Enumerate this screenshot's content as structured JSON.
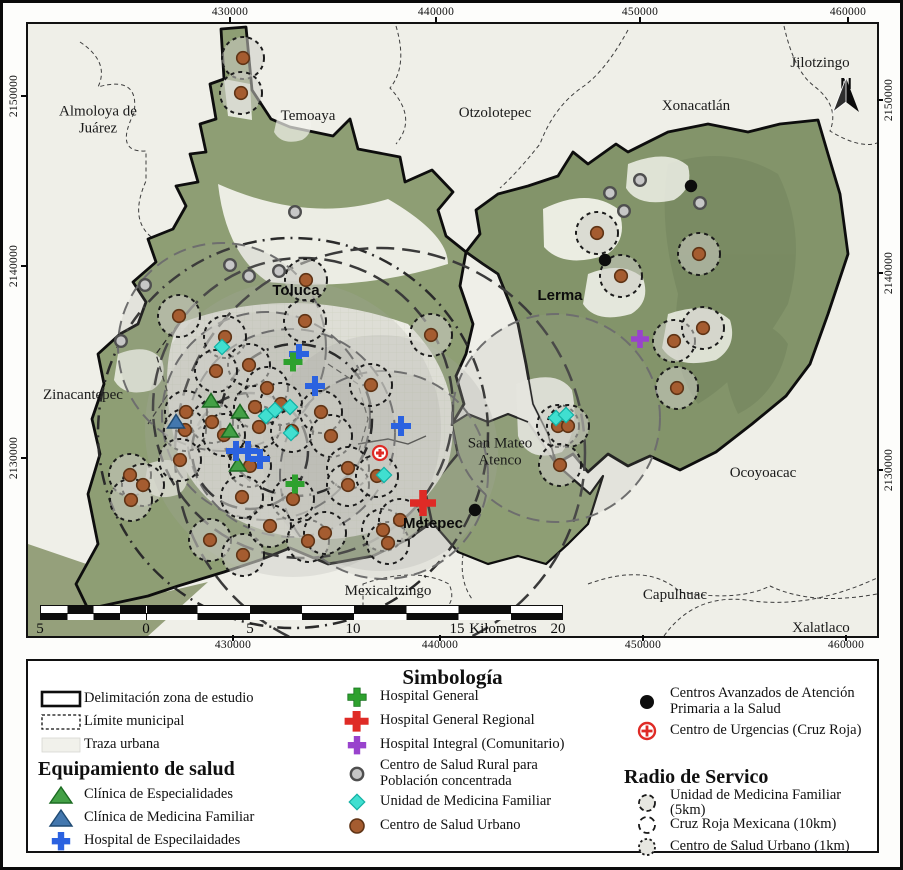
{
  "colors": {
    "black": "#0d0d0d",
    "brown": "#A55C30",
    "brown_dark": "#5F3416",
    "gray": "#C7C7C7",
    "gray_dark": "#4F4F4F",
    "red": "#DF2B26",
    "green": "#2EA12E",
    "purple": "#9943CD",
    "blue": "#2B62E0",
    "green_tri": "#43A046",
    "green_tri_dark": "#1C6B22",
    "blue_tri": "#4377AE",
    "blue_tri_dark": "#1F4A73",
    "cyan": "#40DFD0",
    "cyan_dark": "#14B0A4",
    "zone_fill": "#8E9E74",
    "terrain_fill": "#83946A",
    "urban_fill": "#F2F2EC"
  },
  "map": {
    "north_label": "N",
    "axis_top": [
      {
        "label": "430000",
        "pos": 227
      },
      {
        "label": "440000",
        "pos": 433
      },
      {
        "label": "450000",
        "pos": 637
      },
      {
        "label": "460000",
        "pos": 845
      }
    ],
    "axis_bottom": [
      {
        "label": "430000",
        "pos": 230
      },
      {
        "label": "440000",
        "pos": 437
      },
      {
        "label": "450000",
        "pos": 640
      },
      {
        "label": "460000",
        "pos": 843
      }
    ],
    "axis_left": [
      {
        "label": "2150000",
        "pos": 93
      },
      {
        "label": "2140000",
        "pos": 263
      },
      {
        "label": "2130000",
        "pos": 455
      }
    ],
    "axis_right": [
      {
        "label": "2150000",
        "pos": 97
      },
      {
        "label": "2140000",
        "pos": 270
      },
      {
        "label": "2130000",
        "pos": 467
      }
    ],
    "place_labels": [
      {
        "text": "Almoloya de\nJuárez",
        "x": 70,
        "y": 96,
        "b": 0
      },
      {
        "text": "Temoaya",
        "x": 280,
        "y": 92,
        "b": 0
      },
      {
        "text": "Otzolotepec",
        "x": 467,
        "y": 89,
        "b": 0
      },
      {
        "text": "Xonacatlán",
        "x": 668,
        "y": 82,
        "b": 0
      },
      {
        "text": "Jilotzingo",
        "x": 792,
        "y": 39,
        "b": 0
      },
      {
        "text": "Toluca",
        "x": 268,
        "y": 267,
        "b": 1
      },
      {
        "text": "Lerma",
        "x": 532,
        "y": 272,
        "b": 1
      },
      {
        "text": "Zinacantepec",
        "x": 55,
        "y": 371,
        "b": 0
      },
      {
        "text": "San Mateo\nAtenco",
        "x": 472,
        "y": 428,
        "b": 0
      },
      {
        "text": "Ocoyoacac",
        "x": 735,
        "y": 449,
        "b": 0
      },
      {
        "text": "Metepec",
        "x": 405,
        "y": 500,
        "b": 1
      },
      {
        "text": "Mexicaltzingo",
        "x": 360,
        "y": 567,
        "b": 0
      },
      {
        "text": "Capulhuac",
        "x": 647,
        "y": 571,
        "b": 0
      },
      {
        "text": "Xalatlaco",
        "x": 793,
        "y": 604,
        "b": 0
      }
    ],
    "scalebar_marks": [
      {
        "t": "5",
        "x": 0
      },
      {
        "t": "0",
        "x": 106
      },
      {
        "t": "5",
        "x": 210
      },
      {
        "t": "10",
        "x": 313
      },
      {
        "t": "15",
        "x": 417
      },
      {
        "t": "Kilometros",
        "x": 463
      },
      {
        "t": "20",
        "x": 518
      }
    ],
    "service_circles": [
      [
        265,
        405,
        148,
        "fl"
      ],
      [
        352,
        429,
        118,
        "fl"
      ],
      [
        265,
        409,
        195,
        "dd"
      ],
      [
        352,
        429,
        205,
        "ld"
      ],
      [
        275,
        384,
        150,
        "ld"
      ],
      [
        194,
        323,
        104,
        "d5"
      ],
      [
        238,
        392,
        104,
        "d5"
      ],
      [
        263,
        409,
        104,
        "d5"
      ],
      [
        356,
        451,
        104,
        "d5"
      ],
      [
        528,
        394,
        104,
        "d5"
      ],
      [
        222,
        427,
        58,
        "ld"
      ],
      [
        268,
        396,
        76,
        "dd"
      ]
    ],
    "markers": {
      "csu": [
        [
          215,
          34
        ],
        [
          213,
          69
        ],
        [
          278,
          256
        ],
        [
          151,
          292
        ],
        [
          277,
          297
        ],
        [
          403,
          311
        ],
        [
          197,
          313
        ],
        [
          221,
          341
        ],
        [
          188,
          347
        ],
        [
          239,
          364
        ],
        [
          343,
          361
        ],
        [
          158,
          388
        ],
        [
          184,
          398
        ],
        [
          157,
          406
        ],
        [
          227,
          383
        ],
        [
          231,
          403
        ],
        [
          253,
          380
        ],
        [
          196,
          411
        ],
        [
          264,
          407
        ],
        [
          293,
          388
        ],
        [
          303,
          412
        ],
        [
          320,
          444
        ],
        [
          265,
          475
        ],
        [
          320,
          461
        ],
        [
          349,
          452
        ],
        [
          222,
          442
        ],
        [
          102,
          451
        ],
        [
          115,
          461
        ],
        [
          103,
          476
        ],
        [
          152,
          436
        ],
        [
          182,
          516
        ],
        [
          215,
          531
        ],
        [
          242,
          502
        ],
        [
          280,
          517
        ],
        [
          297,
          509
        ],
        [
          355,
          506
        ],
        [
          360,
          519
        ],
        [
          372,
          496
        ],
        [
          214,
          473
        ],
        [
          569,
          209
        ],
        [
          593,
          252
        ],
        [
          671,
          230
        ],
        [
          646,
          317
        ],
        [
          675,
          304
        ],
        [
          649,
          364
        ],
        [
          530,
          402
        ],
        [
          540,
          402
        ],
        [
          532,
          441
        ]
      ],
      "rural": [
        [
          267,
          188
        ],
        [
          202,
          241
        ],
        [
          221,
          252
        ],
        [
          251,
          247
        ],
        [
          117,
          261
        ],
        [
          93,
          317
        ],
        [
          612,
          156
        ],
        [
          582,
          169
        ],
        [
          672,
          179
        ],
        [
          596,
          187
        ]
      ],
      "caaps": [
        [
          663,
          162
        ],
        [
          577,
          236
        ],
        [
          447,
          486
        ]
      ],
      "cruzroja": [
        [
          352,
          429
        ]
      ],
      "umf": [
        [
          194,
          323
        ],
        [
          238,
          392
        ],
        [
          247,
          386
        ],
        [
          262,
          383
        ],
        [
          263,
          409
        ],
        [
          356,
          451
        ],
        [
          528,
          394
        ],
        [
          538,
          391
        ]
      ],
      "cesp": [
        [
          183,
          377
        ],
        [
          212,
          388
        ],
        [
          202,
          407
        ],
        [
          210,
          441
        ]
      ],
      "cmf": [
        [
          148,
          398
        ]
      ],
      "hesp": [
        [
          271,
          330
        ],
        [
          287,
          362
        ],
        [
          373,
          402
        ],
        [
          208,
          427
        ],
        [
          220,
          427
        ],
        [
          232,
          435
        ]
      ],
      "hgen": [
        [
          265,
          338
        ],
        [
          267,
          460
        ]
      ],
      "hreg": [
        [
          395,
          479
        ]
      ],
      "hint": [
        [
          612,
          315
        ]
      ]
    }
  },
  "legend": {
    "title": "Simbología",
    "left": {
      "items": [
        {
          "label": "Delimitación zona de estudio"
        },
        {
          "label": "Límite municipal"
        },
        {
          "label": "Traza urbana"
        }
      ],
      "header": "Equipamiento de salud",
      "items2": [
        {
          "label": "Clínica de Especialidades"
        },
        {
          "label": "Clínica de Medicina Familiar"
        },
        {
          "label": "Hospital de Especilaidades"
        }
      ]
    },
    "mid": {
      "items": [
        {
          "label": "Hospital General"
        },
        {
          "label": "Hospital General Regional"
        },
        {
          "label": "Hospital Integral (Comunitario)"
        },
        {
          "label": "Centro de Salud Rural para\nPoblación concentrada"
        },
        {
          "label": "Unidad de Medicina Familiar"
        },
        {
          "label": "Centro de Salud Urbano"
        }
      ]
    },
    "right": {
      "items": [
        {
          "label": "Centros Avanzados de Atención\n Primaria a la Salud"
        },
        {
          "label": "Centro de Urgencias (Cruz Roja)"
        }
      ],
      "header": "Radio de Servico",
      "items2": [
        {
          "label": "Unidad de Medicina Familiar (5km)"
        },
        {
          "label": "Cruz Roja Mexicana (10km)"
        },
        {
          "label": "Centro de Salud Urbano (1km)"
        }
      ]
    }
  }
}
